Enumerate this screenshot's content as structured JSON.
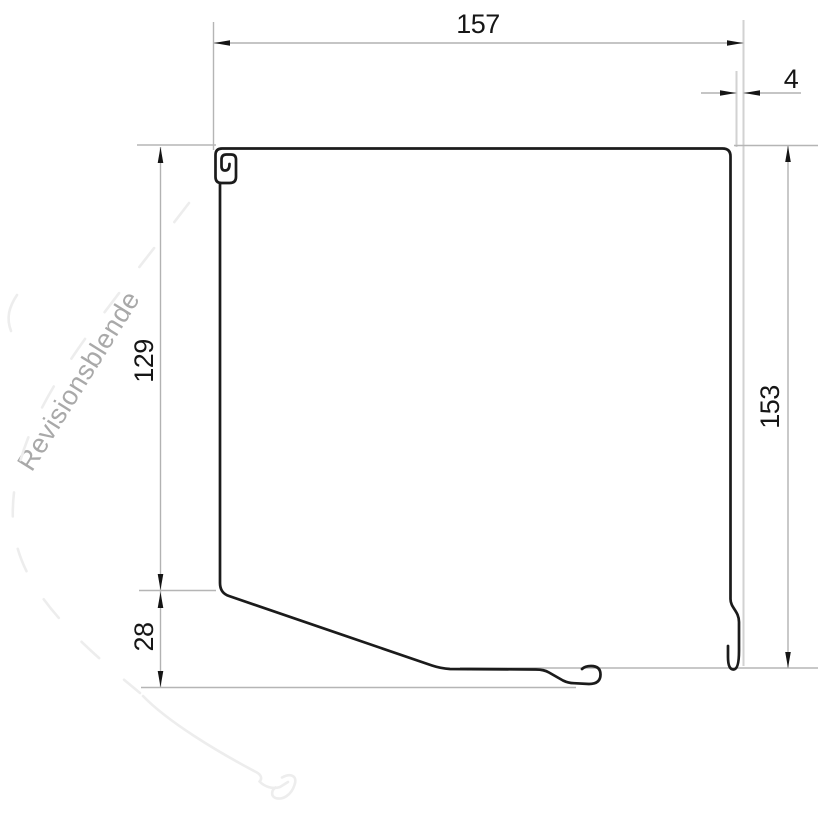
{
  "drawing": {
    "title": "profile-cross-section",
    "watermark": {
      "text": "Revisionsblende",
      "color": "#a9a9a9"
    },
    "dimensions": {
      "top_width": "157",
      "right_offset": "4",
      "left_upper_height": "129",
      "left_lower_height": "28",
      "right_height": "153"
    },
    "colors": {
      "background": "#ffffff",
      "profile_stroke": "#1b1b1b",
      "dimension_line": "#b5b5b5",
      "arrow": "#151515",
      "label_text": "#161616",
      "ghost_line": "#ededed"
    }
  }
}
